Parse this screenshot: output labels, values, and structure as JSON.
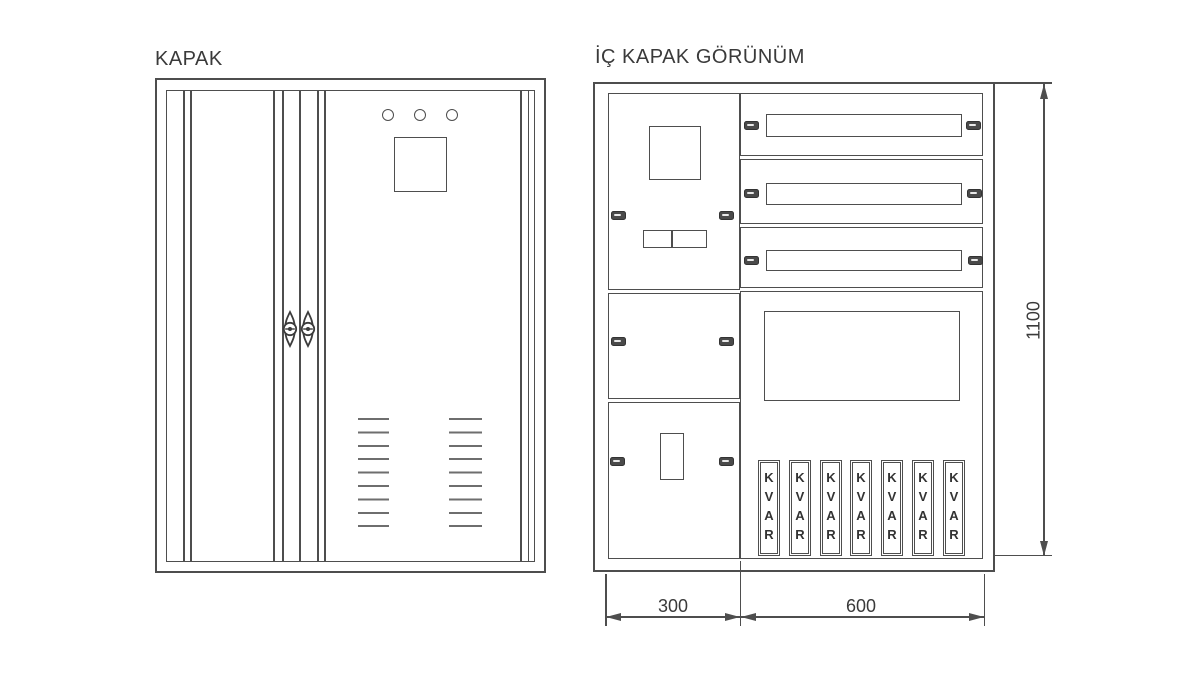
{
  "colors": {
    "background": "#ffffff",
    "line": "#4e4e4e",
    "line_light": "#6e6e6e",
    "text": "#3a3a3a",
    "latch_fill": "#4a4a4a"
  },
  "left_view": {
    "title": "KAPAK"
  },
  "right_view": {
    "title": "İÇ KAPAK GÖRÜNÜM",
    "kvar_label": "KVAR",
    "kvar_count": 7
  },
  "dimensions": {
    "height_mm": "1100",
    "left_width_mm": "300",
    "right_width_mm": "600"
  }
}
